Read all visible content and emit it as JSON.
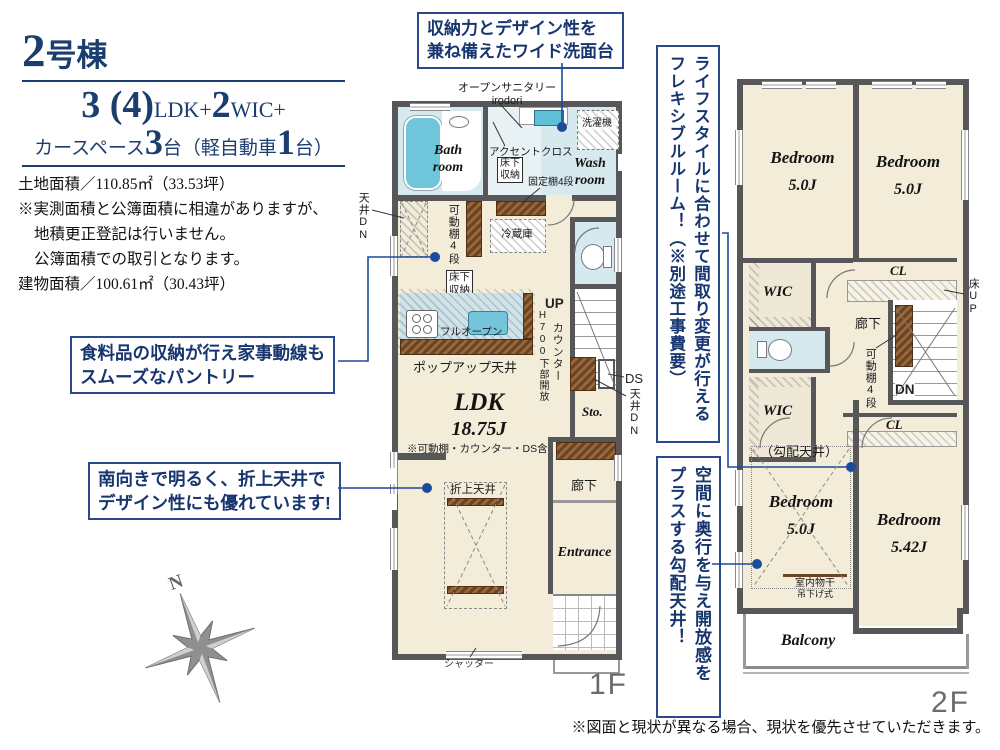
{
  "header": {
    "building_num": "2",
    "building_label": "号棟",
    "spec_num1": "3 (4)",
    "spec_unit1": "LDK+",
    "spec_num2": "2",
    "spec_unit2": "WIC+",
    "car_prefix": "カースペース",
    "car_num1": "3",
    "car_mid": "台（軽自動車",
    "car_num2": "1",
    "car_suffix": "台）",
    "land_area": "土地面積／110.85㎡（33.53坪）",
    "note1": "※実測面積と公簿面積に相違がありますが、",
    "note2": "地積更正登記は行いません。",
    "note3": "公簿面積での取引となります。",
    "building_area": "建物面積／100.61㎡（30.43坪）"
  },
  "callouts": {
    "vanity": "収納力とデザイン性を\n兼ね備えたワイド洗面台",
    "pantry": "食料品の収納が行え家事動線も\nスムーズなパントリー",
    "south": "南向きで明るく、折上天井で\nデザイン性にも優れています!",
    "flexible": "ライフスタイルに合わせて間取り変更が行える\nフレキシブルルーム！（※別途工事費要）",
    "sloped": "空間に奥行を与え開放感を\nプラスする勾配天井！"
  },
  "f1": {
    "floor": "1F",
    "labels": {
      "open_sanitary": "オープンサニタリー\nirodori",
      "bath": "Bath\nroom",
      "accent": "アクセントクロス",
      "laundry": "洗濯機",
      "underfloor1": "床下\n収納",
      "fixed_shelf": "固定棚4段",
      "wash": "Wash\nroom",
      "ceiling_dn_left": "天井DN",
      "movable_shelf": "可動棚4段",
      "fridge": "冷蔵庫",
      "underfloor2": "床下\n収納",
      "full_open": "フルオープン",
      "popup": "ポップアップ天井",
      "up": "UP",
      "counter": "カウンター",
      "counter_note": "H700下部開放",
      "ds": "DS",
      "ceiling_dn_right": "天井DN",
      "sto": "Sto.",
      "ldk": "LDK",
      "ldk_size": "18.75J",
      "ldk_note": "※可動棚・カウンター・DS含",
      "oriage": "折上天井",
      "hallway": "廊下",
      "entrance": "Entrance",
      "shutter": "シャッター"
    }
  },
  "f2": {
    "floor": "2F",
    "labels": {
      "bedroom1": "Bedroom",
      "bedroom1_size": "5.0J",
      "bedroom2": "Bedroom",
      "bedroom2_size": "5.0J",
      "wic1": "WIC",
      "cl1": "CL",
      "floor_up": "床UP",
      "hallway": "廊下",
      "movable_shelf": "可動棚4段",
      "dn": "DN",
      "wic2": "WIC",
      "cl2": "CL",
      "sloped": "（勾配天井）",
      "bedroom3": "Bedroom",
      "bedroom3_size": "5.0J",
      "drying1": "室内物干",
      "drying2": "吊下げ式",
      "bedroom4": "Bedroom",
      "bedroom4_size": "5.42J",
      "balcony": "Balcony"
    }
  },
  "compass": {
    "north": "N"
  },
  "disclaimer": "※図面と現状が異なる場合、現状を優先させていただきます。",
  "colors": {
    "accent_navy": "#1c3e6f",
    "callout_border": "#2a4a8c",
    "wall": "#57575a",
    "room_cream": "#f2ecd9",
    "wet_blue": "#d6e9ee",
    "fixture_teal": "#6fc6db",
    "shelf_brown": "#7c4f28",
    "connector_blue": "#1d4b9b"
  }
}
